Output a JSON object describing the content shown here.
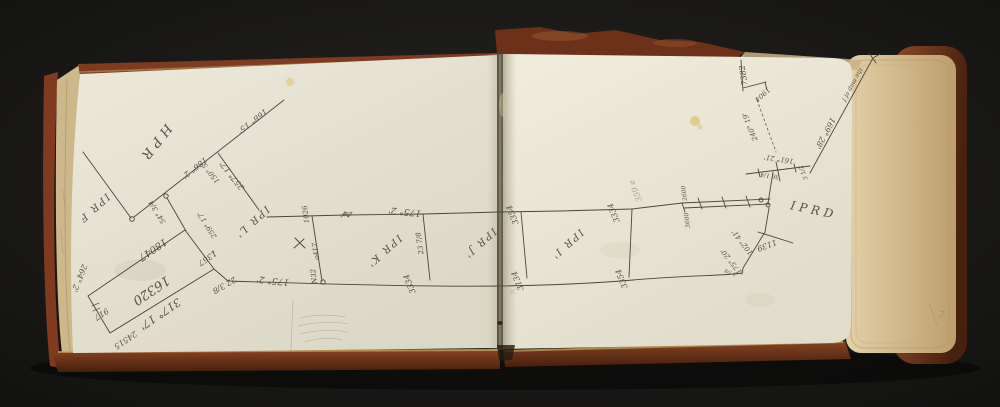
{
  "document": {
    "type": "open sketchbook page spread with hand-drawn survey diagram",
    "page_number": "7"
  },
  "colors": {
    "background": "#1b1a18",
    "cover": "#83401f",
    "cover_dark": "#53250f",
    "gilt_edge": "#c9a55e",
    "page_left": "#e9e6d8",
    "page_right": "#eeebdd",
    "fore_edge": "#d9c69d",
    "ink": "#4a463d",
    "pencil": "#8b887d",
    "foxing": "#d9b658"
  },
  "annotations": [
    {
      "text": "HPR",
      "x": 152,
      "y": 141,
      "rot": 128,
      "size": 13,
      "sp": 5
    },
    {
      "text": "IPR F",
      "x": 92,
      "y": 206,
      "rot": 138,
      "size": 10,
      "sp": 2
    },
    {
      "text": "168° 15'",
      "x": 251,
      "y": 119,
      "rot": 142,
      "size": 8
    },
    {
      "text": "186° 2'",
      "x": 193,
      "y": 166,
      "rot": 142,
      "size": 8
    },
    {
      "text": "150° 5'",
      "x": 212,
      "y": 171,
      "rot": 232,
      "size": 7
    },
    {
      "text": "257° 17'",
      "x": 234,
      "y": 174,
      "rot": 232,
      "size": 8
    },
    {
      "text": "54° 3/4",
      "x": 159,
      "y": 211,
      "rot": 238,
      "size": 7
    },
    {
      "text": "259° 17'",
      "x": 209,
      "y": 224,
      "rot": 238,
      "size": 7
    },
    {
      "text": "IPR L'",
      "x": 250,
      "y": 220,
      "rot": 138,
      "size": 10,
      "sp": 2
    },
    {
      "text": "18047",
      "x": 151,
      "y": 247,
      "rot": 146,
      "size": 10
    },
    {
      "text": "16320",
      "x": 149,
      "y": 287,
      "rot": 146,
      "size": 13
    },
    {
      "text": "317° 17'",
      "x": 158,
      "y": 311,
      "rot": 146,
      "size": 11
    },
    {
      "text": "1367",
      "x": 206,
      "y": 256,
      "rot": 146,
      "size": 8
    },
    {
      "text": "917",
      "x": 100,
      "y": 312,
      "rot": 146,
      "size": 8
    },
    {
      "text": "24515",
      "x": 124,
      "y": 338,
      "rot": 146,
      "size": 8
    },
    {
      "text": "264° 2'",
      "x": 77,
      "y": 277,
      "rot": 112,
      "size": 8
    },
    {
      "text": "22 3/8",
      "x": 223,
      "y": 283,
      "rot": 150,
      "size": 8
    },
    {
      "text": "175° 2'",
      "x": 273,
      "y": 278,
      "rot": 186,
      "size": 9
    },
    {
      "text": "1026",
      "x": 308,
      "y": 214,
      "rot": 262,
      "size": 7
    },
    {
      "text": "a417",
      "x": 318,
      "y": 251,
      "rot": 262,
      "size": 7
    },
    {
      "text": "N32",
      "x": 316,
      "y": 276,
      "rot": 262,
      "size": 7
    },
    {
      "text": "35",
      "x": 347,
      "y": 212,
      "rot": 186,
      "size": 6
    },
    {
      "text": "175° 2'",
      "x": 405,
      "y": 209,
      "rot": 186,
      "size": 9
    },
    {
      "text": "23 7/8",
      "x": 422,
      "y": 243,
      "rot": 262,
      "size": 7
    },
    {
      "text": "3334",
      "x": 412,
      "y": 283,
      "rot": 248,
      "size": 8
    },
    {
      "text": "IPR K'",
      "x": 382,
      "y": 249,
      "rot": 138,
      "size": 10,
      "sp": 2
    },
    {
      "text": "IPR J'",
      "x": 478,
      "y": 241,
      "rot": 138,
      "size": 10,
      "sp": 2
    },
    {
      "text": "3354",
      "x": 515,
      "y": 214,
      "rot": 248,
      "size": 8
    },
    {
      "text": "3134",
      "x": 520,
      "y": 280,
      "rot": 248,
      "size": 8
    },
    {
      "text": "IPR I'",
      "x": 565,
      "y": 242,
      "rot": 138,
      "size": 10,
      "sp": 2
    },
    {
      "text": "3334",
      "x": 616,
      "y": 212,
      "rot": 248,
      "size": 8
    },
    {
      "text": "3354",
      "x": 624,
      "y": 278,
      "rot": 248,
      "size": 8
    },
    {
      "text": "359 e",
      "x": 638,
      "y": 190,
      "rot": 248,
      "size": 8,
      "color": "pencil"
    },
    {
      "text": "2600",
      "x": 686,
      "y": 193,
      "rot": 262,
      "size": 6
    },
    {
      "text": "3600",
      "x": 689,
      "y": 220,
      "rot": 262,
      "size": 6
    },
    {
      "text": "161° 21'",
      "x": 779,
      "y": 157,
      "rot": 188,
      "size": 7
    },
    {
      "text": "36 1/4",
      "x": 770,
      "y": 174,
      "rot": 188,
      "size": 6
    },
    {
      "text": "3 1/2",
      "x": 805,
      "y": 172,
      "rot": 248,
      "size": 6
    },
    {
      "text": "1139",
      "x": 766,
      "y": 243,
      "rot": 160,
      "size": 8
    },
    {
      "text": "102° 41'",
      "x": 744,
      "y": 241,
      "rot": 232,
      "size": 7
    },
    {
      "text": "175° 20'",
      "x": 733,
      "y": 260,
      "rot": 232,
      "size": 7
    },
    {
      "text": "3 7/8",
      "x": 731,
      "y": 271,
      "rot": 200,
      "size": 5
    },
    {
      "text": "IPRD",
      "x": 813,
      "y": 214,
      "rot": 12,
      "size": 12,
      "sp": 4
    },
    {
      "text": "169° 28'",
      "x": 823,
      "y": 132,
      "rot": 118,
      "size": 8
    },
    {
      "text": "the map of f",
      "x": 851,
      "y": 84,
      "rot": 118,
      "size": 6
    },
    {
      "text": "7382",
      "x": 746,
      "y": 75,
      "rot": 262,
      "size": 8
    },
    {
      "text": "1904",
      "x": 761,
      "y": 93,
      "rot": 138,
      "size": 7
    },
    {
      "text": "240° 19'",
      "x": 752,
      "y": 126,
      "rot": 248,
      "size": 7
    },
    {
      "text": "7",
      "x": 941,
      "y": 318,
      "rot": 12,
      "size": 10,
      "color": "pencil"
    }
  ]
}
